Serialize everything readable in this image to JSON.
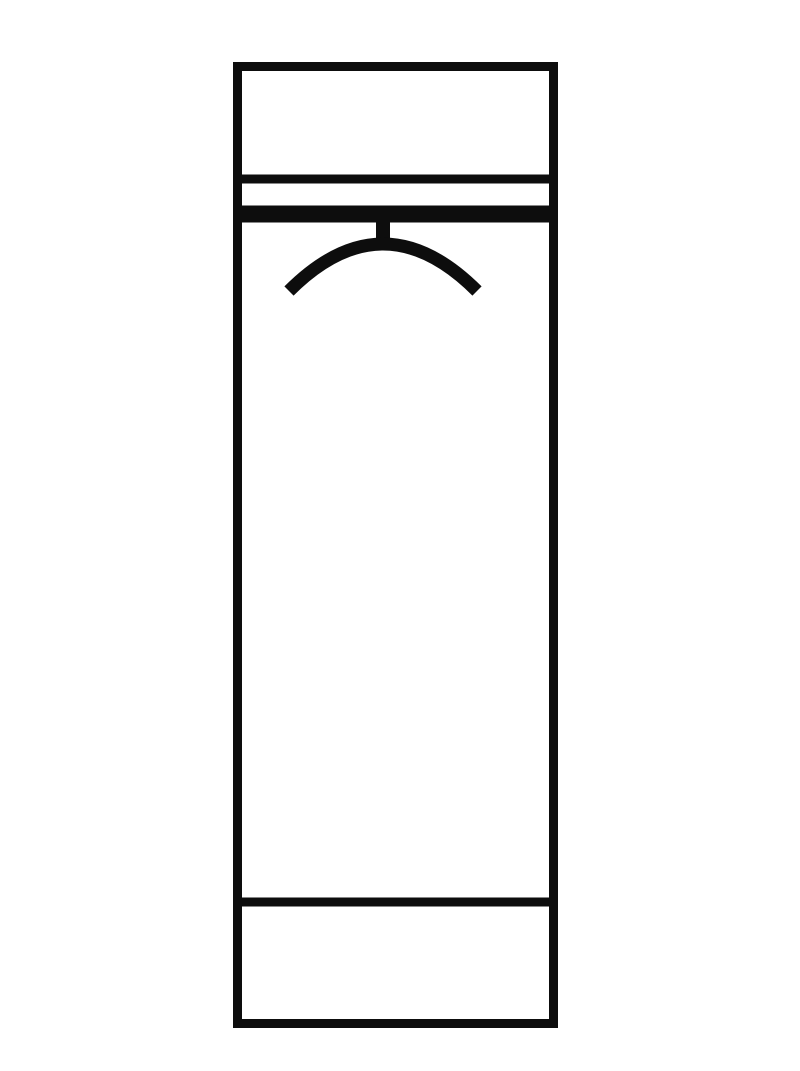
{
  "canvas": {
    "width": 800,
    "height": 1071,
    "background": "#ffffff",
    "stroke_color": "#0d0d0d"
  },
  "diagram": {
    "type": "furniture-schematic",
    "subject": "tall wardrobe front elevation with top shelf, clothes rail with hanger symbol, and bottom plinth",
    "cabinet": {
      "x": 233,
      "y": 62,
      "width": 325,
      "height": 966,
      "stroke_width": 9
    },
    "lines": [
      {
        "name": "top-shelf-line",
        "y": 179,
        "thickness": 9
      },
      {
        "name": "clothes-rail-line",
        "y": 214,
        "thickness": 17
      },
      {
        "name": "bottom-plinth-line",
        "y": 902,
        "thickness": 9
      }
    ],
    "hanger": {
      "stem": {
        "x": 383,
        "y1": 221,
        "y2": 240,
        "thickness": 14
      },
      "arc": {
        "x1": 289,
        "y1": 291,
        "cx": 383,
        "cy": 197,
        "x2": 477,
        "y2": 291,
        "thickness": 13
      }
    }
  }
}
